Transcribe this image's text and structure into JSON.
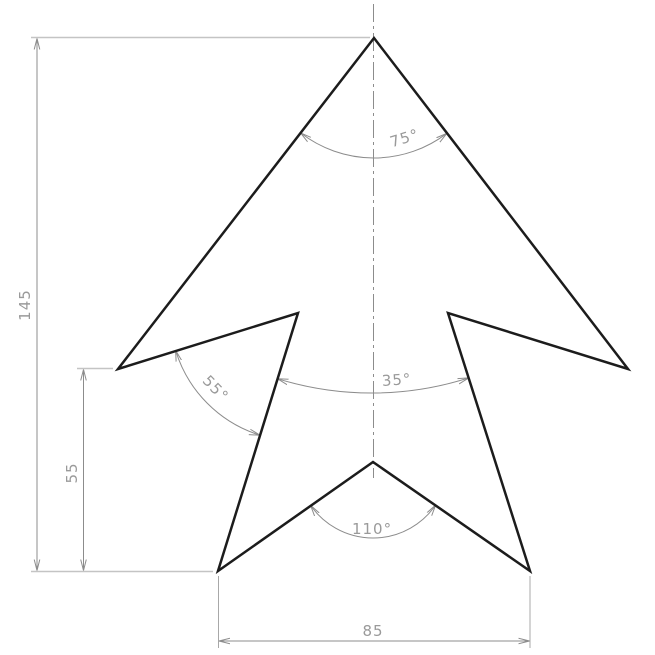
{
  "drawing": {
    "type": "technical-dimensioned-drawing",
    "shape": "four-pointed arrow / star outline",
    "colors": {
      "background": "#ffffff",
      "outline": "#1c1c1c",
      "dimension_lines": "#8c8c8c",
      "extension_lines": "#c4c4c4",
      "dimension_text": "#9a9a9a"
    },
    "linear_dimensions": {
      "total_height": {
        "label": "145",
        "orientation": "vertical"
      },
      "wing_height": {
        "label": "55",
        "orientation": "vertical"
      },
      "base_width": {
        "label": "85",
        "orientation": "horizontal"
      }
    },
    "angular_dimensions": {
      "apex_angle": {
        "label": "75°"
      },
      "barb_angle": {
        "label": "55°"
      },
      "leg_angle": {
        "label": "35°"
      },
      "notch_angle": {
        "label": "110°"
      }
    },
    "geometry": {
      "outline_points": "374,38 628,369 448,313 530,571 373,462 218,571 298,313 118,369",
      "apex_arc_path": "M300.6,132.9 A120,120 0 0 0 446.9,133.3",
      "barb_arc_path": "M175.6,350.4 A128,128 0 0 0 260,435.2",
      "leg_arc_path": "M277.4,378.7 A318,318 0 0 0 468.7,377.9",
      "notch_arc_path": "M310.6,505.4 A76,76 0 0 0 435.6,505.1"
    }
  }
}
